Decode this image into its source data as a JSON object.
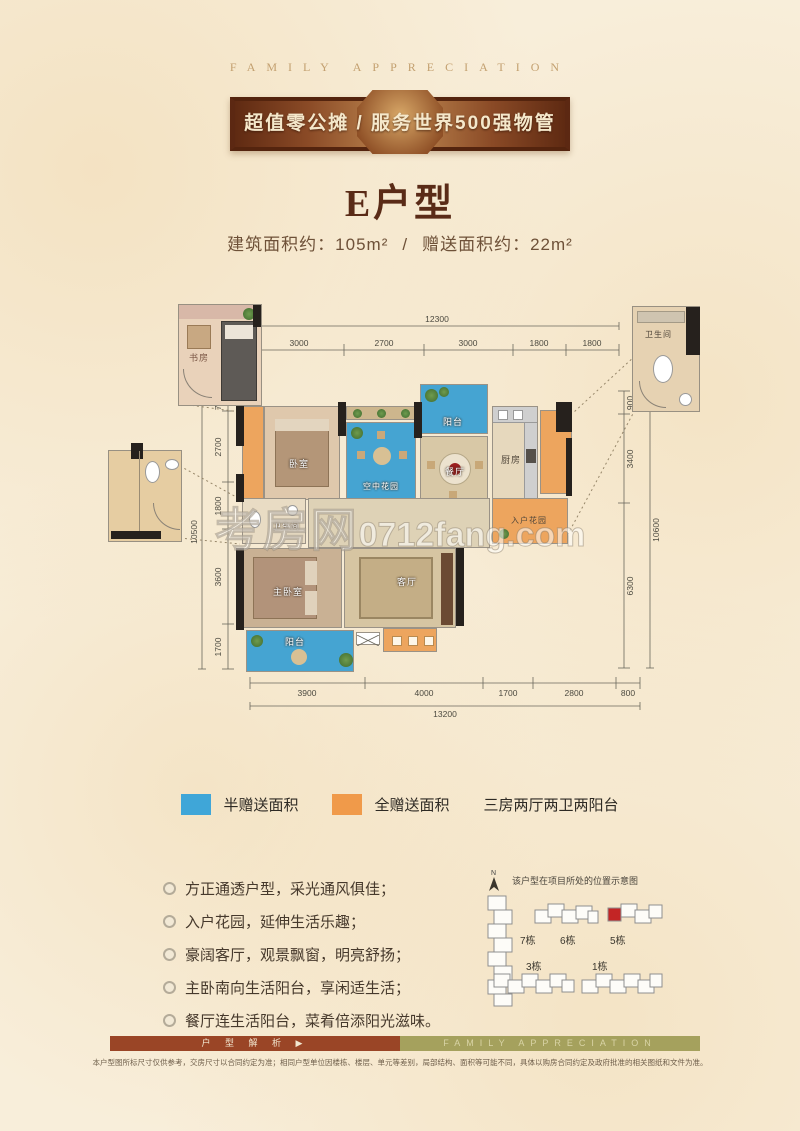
{
  "header": {
    "eyebrow": "FAMILY APPRECIATION",
    "ribbon": "超值零公摊 / 服务世界500强物管",
    "title": "E户型",
    "area_built": "建筑面积约：105m²",
    "area_sep": "/",
    "area_gift": "赠送面积约：22m²"
  },
  "plan": {
    "watermark_cn": "考房网",
    "watermark_en": "0712fang.com",
    "rooms": {
      "study": "书房",
      "bath_top": "卫生间",
      "bedroom": "卧室",
      "sky_garden": "空中花园",
      "balcony_top": "阳台",
      "dining": "餐厅",
      "kitchen": "厨房",
      "entry_garden": "入户花园",
      "bathroom": "卫生间",
      "master": "主卧室",
      "living": "客厅",
      "balcony_bottom": "阳台"
    },
    "dims": {
      "top": {
        "total": "12300",
        "segs": [
          "3000",
          "2700",
          "3000",
          "1800",
          "1800"
        ]
      },
      "left": {
        "total": "10500",
        "segs": [
          "700",
          "2700",
          "1800",
          "3600",
          "1700"
        ]
      },
      "right": {
        "total": "10600",
        "segs": [
          "900",
          "3400",
          "6300"
        ]
      },
      "bottom": {
        "total": "13200",
        "segs": [
          "3900",
          "4000",
          "1700",
          "2800",
          "800"
        ]
      }
    }
  },
  "legend": {
    "half_gift": {
      "color": "#3fa6d8",
      "label": "半赠送面积"
    },
    "full_gift": {
      "color": "#f09a4a",
      "label": "全赠送面积"
    },
    "summary": "三房两厅两卫两阳台"
  },
  "features": [
    "方正通透户型，采光通风俱佳；",
    "入户花园，延伸生活乐趣；",
    "豪阔客厅，观景飘窗，明亮舒扬；",
    "主卧南向生活阳台，享闲适生活；",
    "餐厅连生活阳台，菜肴倍添阳光滋味。"
  ],
  "siteplan": {
    "north": "N",
    "caption": "该户型在项目所处的位置示意图",
    "buildings": [
      "7栋",
      "6栋",
      "5栋",
      "3栋",
      "1栋"
    ],
    "highlight": "#c32525"
  },
  "footer": {
    "bar_left": "户 型 解 析 ▶",
    "bar_right": "FAMILY APPRECIATION",
    "disclaimer": "本户型图所标尺寸仅供参考，交房尺寸以合同约定为准；相同户型单位因楼栋、楼层、单元等差别，局部结构、面积等可能不同，具体以购房合同约定及政府批准的相关图纸和文件为准。"
  }
}
